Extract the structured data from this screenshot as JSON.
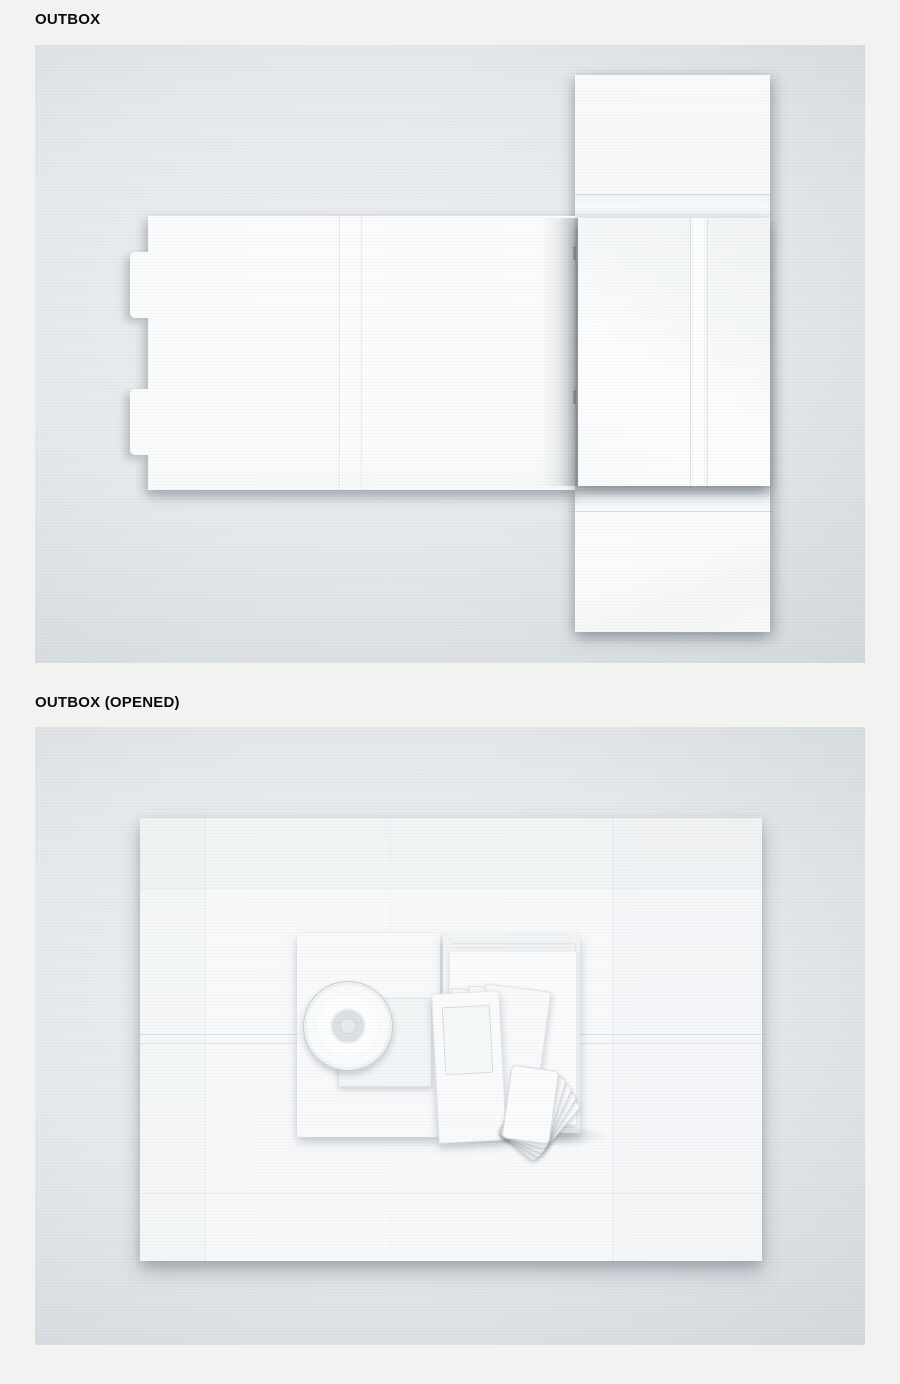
{
  "page": {
    "background_color": "#f2f2f0",
    "heading_color": "#0b0b0b"
  },
  "sections": [
    {
      "id": "outbox",
      "heading": "OUTBOX",
      "panel": {
        "background_center": "#eef0f2",
        "background_edge": "#c8ced3",
        "parts": [
          "wrap-strip",
          "body-panel",
          "front-lid",
          "spine-rib",
          "locking-tab-top",
          "locking-tab-bottom"
        ]
      }
    },
    {
      "id": "outbox-opened",
      "heading": "OUTBOX (OPENED)",
      "panel": {
        "background_center": "#eef0f2",
        "background_edge": "#c8ced3",
        "contents": [
          "opened-box-sheet",
          "cd-sleeve",
          "cd-disc",
          "inner-sheet",
          "booklet-stack",
          "booklet-cover",
          "folded-leaflets",
          "photocard-stack"
        ],
        "photocard_count": 5,
        "leaflet_count": 4
      }
    }
  ],
  "colors": {
    "paper_white": "#fcfdfd",
    "crease_line": "#c4cbd1",
    "shadow": "rgba(88,98,110,0.45)",
    "cd_hub": "#dde0e3",
    "cd_hole": "#e8eaec",
    "cd_rim": "#c7ccd0"
  }
}
